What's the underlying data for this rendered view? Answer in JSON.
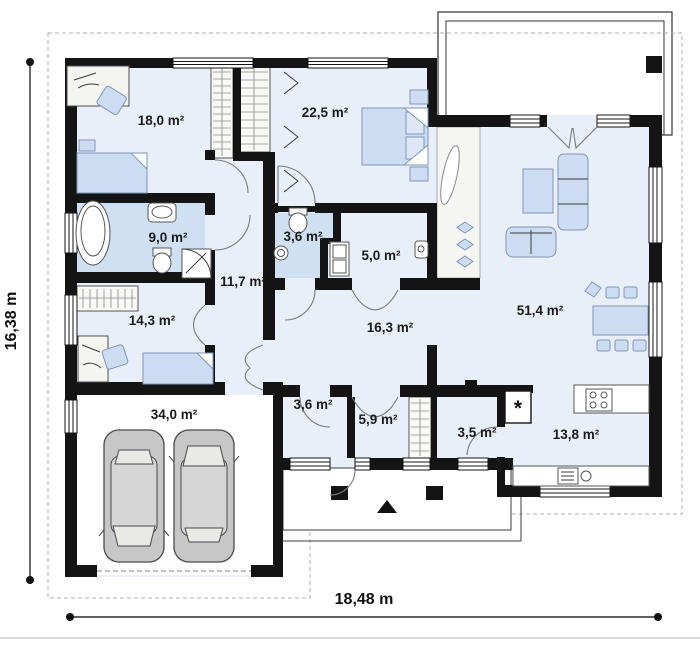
{
  "plan": {
    "dimensions": {
      "height_label": "16,38 m",
      "width_label": "18,48 m"
    },
    "rooms": [
      {
        "id": "bedroom-front",
        "area_label": "18,0 m²"
      },
      {
        "id": "bedroom-middle",
        "area_label": "22,5 m²"
      },
      {
        "id": "bathroom",
        "area_label": "9,0 m²"
      },
      {
        "id": "wc-upper",
        "area_label": "3,6 m²"
      },
      {
        "id": "utility",
        "area_label": "5,0 m²"
      },
      {
        "id": "hallway-bedrooms",
        "area_label": "11,7 m²"
      },
      {
        "id": "bedroom-side",
        "area_label": "14,3 m²"
      },
      {
        "id": "hallway-main",
        "area_label": "16,3 m²"
      },
      {
        "id": "living-room",
        "area_label": "51,4 m²"
      },
      {
        "id": "garage",
        "area_label": "34,0 m²"
      },
      {
        "id": "wc-lower",
        "area_label": "3,6 m²"
      },
      {
        "id": "vestibule",
        "area_label": "5,9 m²"
      },
      {
        "id": "pantry",
        "area_label": "3,5 m²"
      },
      {
        "id": "kitchen",
        "area_label": "13,8 m²"
      }
    ],
    "markers": {
      "boiler": "*"
    },
    "colors": {
      "wall": "#141414",
      "floor": "#e9eff8",
      "wet_floor": "#cfe0f2",
      "furniture": "#ccddf1",
      "furniture_outline": "#7d96ba"
    }
  }
}
